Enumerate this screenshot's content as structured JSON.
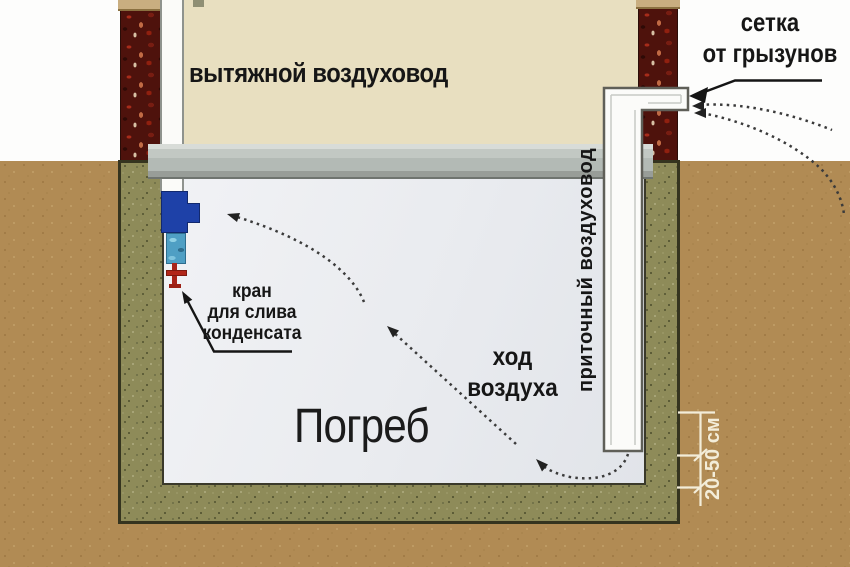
{
  "diagram": {
    "labels": {
      "exhaust_duct": "вытяжной воздуховод",
      "rodent_mesh": "сетка\nот грызунов",
      "condensate_tap": "кран\nдля слива\nконденсата",
      "air_flow": "ход\nвоздуха",
      "cellar": "Погреб",
      "supply_duct": "приточный воздуховод",
      "dimension": "20-50 см"
    },
    "colors": {
      "soil": "#b18b54",
      "cellar_wall": "#8e8b59",
      "cellar_interior": "#edeff3",
      "house_wall": "#e8dfc0",
      "brick": "#4e120c",
      "ceiling_beam": "#bcc1bd",
      "duct_white": "#fbfbf9",
      "fan_blue": "#1e41a8",
      "sticker_teal": "#4f9fc4",
      "tap_red": "#ab2418",
      "label_text": "#161616",
      "dimension_white": "#f3edd9"
    }
  }
}
